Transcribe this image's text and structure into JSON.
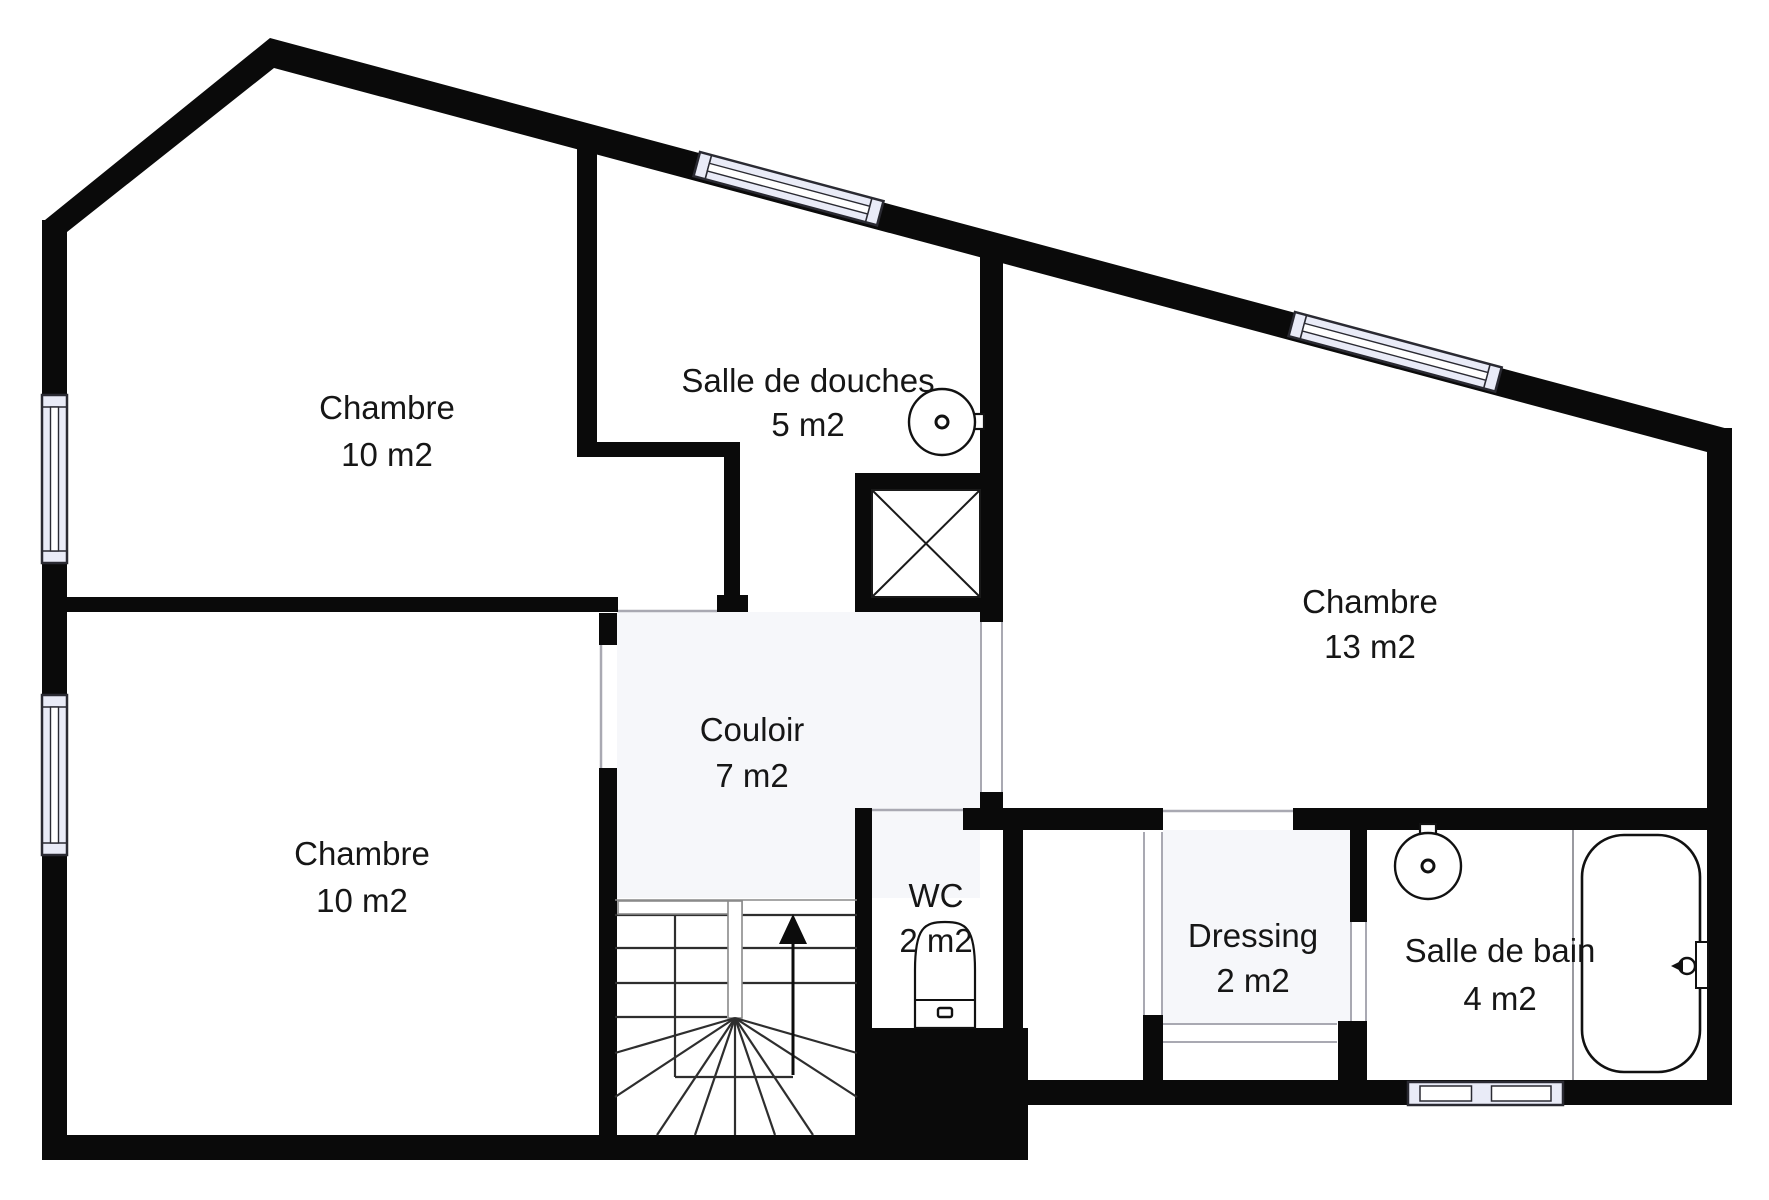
{
  "title": "Floor plan – étage (chambres, salle de douches, salle de bain)",
  "canvas": {
    "width": 1769,
    "height": 1200,
    "background": "#ffffff"
  },
  "colors": {
    "wall": "#0a0a0a",
    "thin": "#1a1a1a",
    "tread": "#2e2e2e",
    "door_line": "#a9a9b2",
    "rail_line": "#8a8a8a",
    "window_fill": "#e9ebf7",
    "window_line": "#2a2a32",
    "tint": "#f6f7fa",
    "partition": "#9a9aa0",
    "text": "#161616"
  },
  "rooms": [
    {
      "id": "chambre-haut-gauche",
      "label": "Chambre",
      "area": "10 m2",
      "cx": 387,
      "y1": 419,
      "y2": 466
    },
    {
      "id": "salle-de-douches",
      "label": "Salle de douches",
      "area": "5 m2",
      "cx": 808,
      "y1": 392,
      "y2": 436
    },
    {
      "id": "chambre-droite",
      "label": "Chambre",
      "area": "13 m2",
      "cx": 1370,
      "y1": 613,
      "y2": 658
    },
    {
      "id": "couloir",
      "label": "Couloir",
      "area": "7 m2",
      "cx": 752,
      "y1": 741,
      "y2": 787
    },
    {
      "id": "chambre-bas-gauche",
      "label": "Chambre",
      "area": "10 m2",
      "cx": 362,
      "y1": 865,
      "y2": 912
    },
    {
      "id": "wc",
      "label": "WC",
      "area": "2 m2",
      "cx": 936,
      "y1": 907,
      "y2": 952
    },
    {
      "id": "dressing",
      "label": "Dressing",
      "area": "2 m2",
      "cx": 1253,
      "y1": 947,
      "y2": 992
    },
    {
      "id": "salle-de-bain",
      "label": "Salle de bain",
      "area": "4 m2",
      "cx": 1500,
      "y1": 962,
      "y2": 1010
    }
  ],
  "plan": {
    "tints": [
      {
        "x": 617,
        "y": 612,
        "w": 363,
        "h": 286
      },
      {
        "x": 855,
        "y": 612,
        "w": 125,
        "h": 198
      },
      {
        "x": 1163,
        "y": 830,
        "w": 187,
        "h": 193
      }
    ],
    "wall_polygons": [
      {
        "name": "roof-band",
        "points": "45,220 270,38 1732,430 1732,452 1707,452 274,68 67,232 45,232"
      }
    ],
    "wall_rects": [
      {
        "name": "left-wall",
        "x": 42,
        "y": 220,
        "w": 25,
        "h": 940
      },
      {
        "name": "right-wall",
        "x": 1707,
        "y": 428,
        "w": 25,
        "h": 677
      },
      {
        "name": "bottom-wall-right",
        "x": 1028,
        "y": 1080,
        "w": 704,
        "h": 25
      },
      {
        "name": "bottom-wall-left",
        "x": 42,
        "y": 1135,
        "w": 815,
        "h": 25
      },
      {
        "name": "wc-floor-block",
        "x": 855,
        "y": 1028,
        "w": 173,
        "h": 132
      },
      {
        "name": "mid-wall-left",
        "x": 50,
        "y": 597,
        "w": 568,
        "h": 15
      },
      {
        "name": "door-jamb-block",
        "x": 717,
        "y": 595,
        "w": 31,
        "h": 17
      },
      {
        "name": "shaft-bottom-wall",
        "x": 855,
        "y": 597,
        "w": 148,
        "h": 15
      },
      {
        "name": "wall-douches-left",
        "x": 577,
        "y": 148,
        "w": 20,
        "h": 309
      },
      {
        "name": "wall-jog-horizontal",
        "x": 577,
        "y": 442,
        "w": 163,
        "h": 15
      },
      {
        "name": "wall-jog-vertical",
        "x": 724,
        "y": 457,
        "w": 16,
        "h": 140
      },
      {
        "name": "stub-chambre-bas",
        "x": 599,
        "y": 613,
        "w": 18,
        "h": 32
      },
      {
        "name": "wall-stairs-left",
        "x": 599,
        "y": 768,
        "w": 18,
        "h": 370
      },
      {
        "name": "wc-left-wall",
        "x": 855,
        "y": 808,
        "w": 17,
        "h": 222
      },
      {
        "name": "south-wall-a",
        "x": 963,
        "y": 808,
        "w": 200,
        "h": 22
      },
      {
        "name": "south-wall-b",
        "x": 1293,
        "y": 808,
        "w": 439,
        "h": 22
      },
      {
        "name": "stub-chambre13-door",
        "x": 980,
        "y": 792,
        "w": 23,
        "h": 21
      },
      {
        "name": "wc-right-wall",
        "x": 1003,
        "y": 827,
        "w": 20,
        "h": 255
      },
      {
        "name": "dressing-left-lower",
        "x": 1143,
        "y": 1015,
        "w": 20,
        "h": 67
      },
      {
        "name": "dressing-right-upper",
        "x": 1350,
        "y": 830,
        "w": 17,
        "h": 92
      },
      {
        "name": "dressing-right-block",
        "x": 1338,
        "y": 1021,
        "w": 29,
        "h": 61
      },
      {
        "name": "shaft-top-wall",
        "x": 855,
        "y": 473,
        "w": 148,
        "h": 17
      },
      {
        "name": "shaft-left-wall",
        "x": 855,
        "y": 473,
        "w": 17,
        "h": 139
      },
      {
        "name": "wall-chambre13-left",
        "x": 980,
        "y": 255,
        "w": 23,
        "h": 367
      }
    ],
    "door_strips": [
      {
        "name": "door-couloir-chambre13",
        "x": 980,
        "y": 622,
        "w": 23,
        "h": 170,
        "dir": "v"
      },
      {
        "name": "door-dressing-left",
        "x": 1143,
        "y": 832,
        "w": 20,
        "h": 183,
        "dir": "v"
      },
      {
        "name": "door-salle-de-bain",
        "x": 1350,
        "y": 922,
        "w": 17,
        "h": 99,
        "dir": "v"
      },
      {
        "name": "door-dressing-bottom",
        "x": 1163,
        "y": 1023,
        "w": 174,
        "h": 20,
        "dir": "h"
      }
    ],
    "door_lines": [
      {
        "name": "door-chambre-haut",
        "x1": 618,
        "y1": 611,
        "x2": 717,
        "y2": 611
      },
      {
        "name": "door-wc",
        "x1": 872,
        "y1": 810,
        "x2": 963,
        "y2": 810
      },
      {
        "name": "door-dressing-top",
        "x1": 1163,
        "y1": 811,
        "x2": 1293,
        "y2": 811
      },
      {
        "name": "door-chambre-bas",
        "x1": 601,
        "y1": 645,
        "x2": 601,
        "y2": 768
      }
    ],
    "windows": {
      "left": [
        {
          "x": 42,
          "y": 395,
          "w": 25,
          "h": 168
        },
        {
          "x": 42,
          "y": 695,
          "w": 25,
          "h": 160
        }
      ],
      "slope": [
        {
          "x": 700,
          "y": 152,
          "len": 190,
          "th": 25,
          "angle": 15
        },
        {
          "x": 1295,
          "y": 312,
          "len": 214,
          "th": 25,
          "angle": 15
        }
      ],
      "bottom": {
        "x": 1408,
        "y": 1082,
        "w": 155,
        "h": 23
      }
    },
    "shaft": {
      "x": 872,
      "y": 490,
      "w": 108,
      "h": 107
    },
    "stairs": {
      "left": 615,
      "right": 857,
      "top": 900,
      "bottom": 1135,
      "treads_full": [
        915,
        948,
        983
      ],
      "tread_part": {
        "y": 1017,
        "x1": 615,
        "x2": 727
      },
      "vline": {
        "x": 675,
        "y1": 915,
        "y2": 1077
      },
      "hline": {
        "y": 1077,
        "x1": 675,
        "x2": 793
      },
      "rail": [
        {
          "x": 618,
          "y": 901,
          "w": 124,
          "h": 13
        },
        {
          "x": 728,
          "y": 901,
          "w": 14,
          "h": 117
        }
      ],
      "fan_center": [
        735,
        1018
      ],
      "fan_ends": [
        [
          615,
          1053
        ],
        [
          615,
          1097
        ],
        [
          657,
          1135
        ],
        [
          695,
          1135
        ],
        [
          735,
          1135
        ],
        [
          775,
          1135
        ],
        [
          813,
          1135
        ],
        [
          857,
          1097
        ],
        [
          857,
          1053
        ]
      ],
      "arrow": {
        "x": 793,
        "y1": 1075,
        "y2": 944,
        "head": [
          [
            793,
            914
          ],
          [
            779,
            944
          ],
          [
            807,
            944
          ]
        ]
      }
    },
    "fixtures": {
      "washbasins": [
        {
          "cx": 942,
          "cy": 422,
          "r": 33,
          "tap": {
            "x": 958,
            "y": 414,
            "w": 26,
            "h": 15
          }
        },
        {
          "cx": 1428,
          "cy": 866,
          "r": 33,
          "tap": {
            "x": 1420,
            "y": 824,
            "w": 16,
            "h": 26
          }
        }
      ],
      "bathtub": {
        "x": 1582,
        "y": 835,
        "w": 118,
        "h": 237,
        "rx": 42,
        "plate": {
          "x": 1696,
          "y": 942,
          "w": 12,
          "h": 46
        },
        "knob": {
          "cx": 1687,
          "cy": 966,
          "r": 8
        }
      },
      "toilet": {
        "x": 915,
        "top": 922,
        "w": 60,
        "bottom": 1028,
        "line_y": 1000,
        "button": {
          "x": 938,
          "y": 1008,
          "w": 14,
          "h": 9
        }
      },
      "partition_line": {
        "x1": 1573,
        "y1": 830,
        "x2": 1573,
        "y2": 1080
      }
    }
  }
}
